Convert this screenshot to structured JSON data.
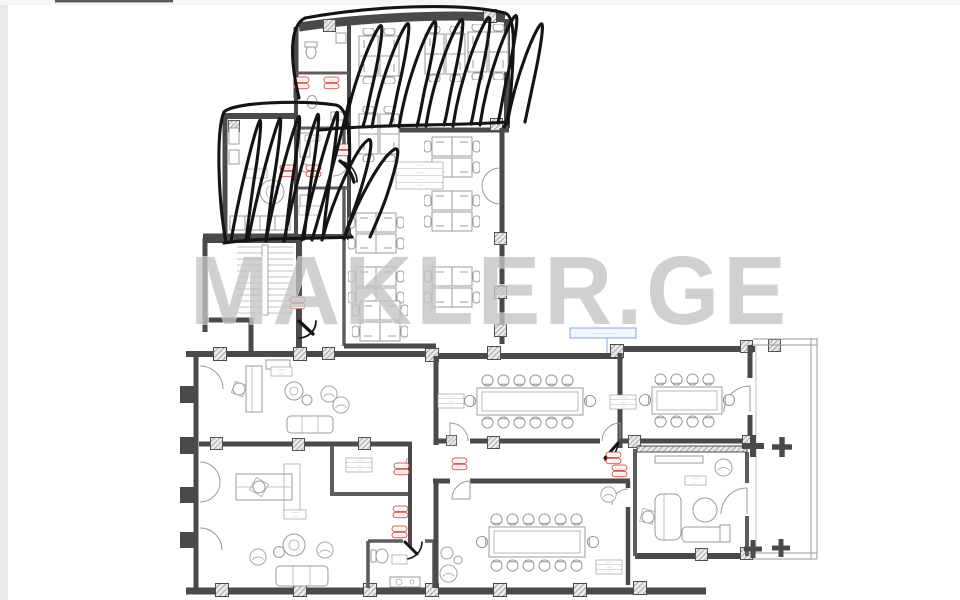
{
  "watermark": {
    "text": "MAKLER.GE",
    "color": "#c3c3c3"
  },
  "blue_note": {
    "text": "· ···· ····· ···· · ·····"
  },
  "door_tag": {
    "line1": "·····",
    "line2": "·····"
  },
  "labels": {
    "central_office": {
      "rows": [
        "········",
        "········",
        "······",
        "···.··"
      ]
    },
    "conf_left": {
      "rows": [
        "·········",
        "·····",
        "··.·"
      ]
    },
    "conf_right": {
      "rows": [
        "·········",
        "·····",
        "··.·"
      ]
    },
    "conf_bottom": {
      "rows": [
        "·········",
        "·····",
        "··.·"
      ]
    },
    "closet": {
      "rows": [
        "········",
        "·····",
        "·.··"
      ]
    },
    "reception": {
      "rows": [
        "······",
        "··.··"
      ]
    },
    "office_left": {
      "rows": [
        "·······",
        "··.··"
      ]
    },
    "office_right": {
      "rows": [
        "······",
        "·.··"
      ]
    },
    "wc": {
      "rows": [
        "···",
        "·.··"
      ]
    },
    "top_left_room": {
      "rows": [
        "·······",
        "·.··"
      ]
    },
    "hall": {
      "rows": [
        "······",
        "·.··"
      ]
    },
    "service": {
      "rows": [
        "····"
      ]
    }
  }
}
